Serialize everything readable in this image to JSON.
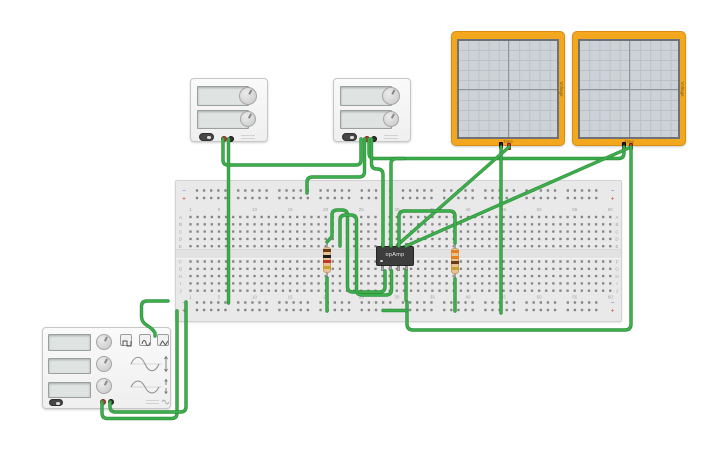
{
  "canvas": {
    "width": 725,
    "height": 453,
    "background": "#ffffff"
  },
  "colors": {
    "wire": "#3cae4b",
    "board": "#e9e9e9",
    "hole": "#878787",
    "label": "#a3a3a3",
    "rail_minus": "#3a6fc4",
    "rail_plus": "#c0392b",
    "scope_frame": "#f2a71f"
  },
  "breadboard": {
    "x": 175,
    "y": 180,
    "w": 447,
    "h": 142,
    "cols": 60,
    "col0": 190.5,
    "dx": 7.115,
    "rows_top": [
      217,
      224.3,
      231.6,
      238.9,
      246.2
    ],
    "rows_bottom": [
      261.5,
      268.8,
      276.1,
      283.4,
      290.7
    ],
    "rail_rows": [
      190.5,
      198,
      302.5,
      310
    ],
    "rail_x": {
      "start": 197,
      "group_pitch": 41.2,
      "dx": 7.115,
      "groups": 10,
      "per_group": 5
    },
    "number_labels": [
      1,
      5,
      10,
      15,
      20,
      25,
      30,
      35,
      40,
      45,
      50,
      55,
      60
    ],
    "number_rows_y": [
      211,
      298.5
    ],
    "row_letters_top": [
      "A",
      "B",
      "C",
      "D",
      "E"
    ],
    "row_letters_bottom": [
      "F",
      "G",
      "H",
      "I",
      "J"
    ],
    "letter_x": [
      180.5,
      617
    ],
    "rail_symbols": {
      "minus": "−",
      "plus": "+"
    }
  },
  "oscilloscope_labels": {
    "time_label": "Time",
    "voltage_label": "Voltage"
  },
  "chip": {
    "label": "opAmp"
  },
  "resistors": [
    {
      "name": "resistor-1k",
      "bands": [
        "#6b3a16",
        "#1d1d1d",
        "#c0392b",
        "#c8a034"
      ]
    },
    {
      "name": "resistor-330",
      "bands": [
        "#e67e22",
        "#e67e22",
        "#6b3a16",
        "#c8a034"
      ]
    }
  ],
  "wires": [
    {
      "name": "wire-ps1-pos-to-ps2",
      "path": "M223,139 V160 Q223,165 228,165 H356 Q361,165 361,160 V139"
    },
    {
      "name": "wire-ps1-neg-to-bottom-rail",
      "path": "M228.5,139 V303"
    },
    {
      "name": "wire-ps2-neg-to-scope2",
      "path": "M369,139 V153 Q369,158.5 374.5,158.5 H618.5 Q624,158.5 624,153 V147"
    },
    {
      "name": "wire-top-rail-to-ps2-pos",
      "path": "M307,193 V182.5 Q307,177 312.5,177 H359 Q364.5,177 364.5,171.5 V139"
    },
    {
      "name": "wire-scope1-neg-down",
      "path": "M501,147 V313"
    },
    {
      "name": "wire-scope1-pos-to-chip",
      "path": "M509,147 L397.5,245"
    },
    {
      "name": "wire-scope2-pos-to-chip",
      "path": "M631,147 L406,246"
    },
    {
      "name": "wire-scope2-neg-loop",
      "path": "M631,147 V324 Q631,330 625,330 H413 Q407,330 407,324 V302"
    },
    {
      "name": "wire-fg-pos",
      "path": "M102,402 V413 Q102,418.5 107.5,418.5 H171.5 Q177,418.5 177,413 V311"
    },
    {
      "name": "wire-fg-neg",
      "path": "M110,402 V406.5 Q110,412 115.5,412 H180.5 Q186,412 186,406.5 V302"
    },
    {
      "name": "wire-rail-hook",
      "path": "M168,301 H147 Q141.5,301 141.5,306.5 V316 Q141.5,322 146.5,325 Q153,329 155,333 V336"
    },
    {
      "name": "wire-r1-to-chip-a",
      "path": "M327,242 L332,236.5 V215 Q332,210 337.5,210 H342 Q347.5,210 347.5,215.5 V286.5 Q347.5,292 353,292 H379.5 Q385,292 385,286.5 V271"
    },
    {
      "name": "wire-r1-to-chip-b",
      "path": "M340,246 V220.5 Q340,215 345.5,215 H351 Q356.5,215 356.5,220.5 V289.5 Q356.5,295 362,295 H386 Q391.5,295 391.5,289.5 V271"
    },
    {
      "name": "wire-ps2-to-chip-top",
      "path": "M371.5,139 V163.5 Q371.5,169 377,169 H377.5 Q383,169 383,174.5 V246"
    },
    {
      "name": "wire-chip-top-up",
      "path": "M391,246 V164 Q391,158.5 396.5,158.5 H404"
    },
    {
      "name": "wire-chip-to-r2",
      "path": "M399,246 V216.5 Q399,211 404.5,211 H449.5 Q455,211 455,216.5 V243"
    },
    {
      "name": "wire-chip-bottom-down",
      "path": "M406,271 V300"
    },
    {
      "name": "wire-bottom-rail-jumper",
      "path": "M383,310.5 H407"
    },
    {
      "name": "wire-r1-bottom",
      "path": "M327,278 V311"
    },
    {
      "name": "wire-r2-bottom",
      "path": "M455,279 V311"
    }
  ]
}
